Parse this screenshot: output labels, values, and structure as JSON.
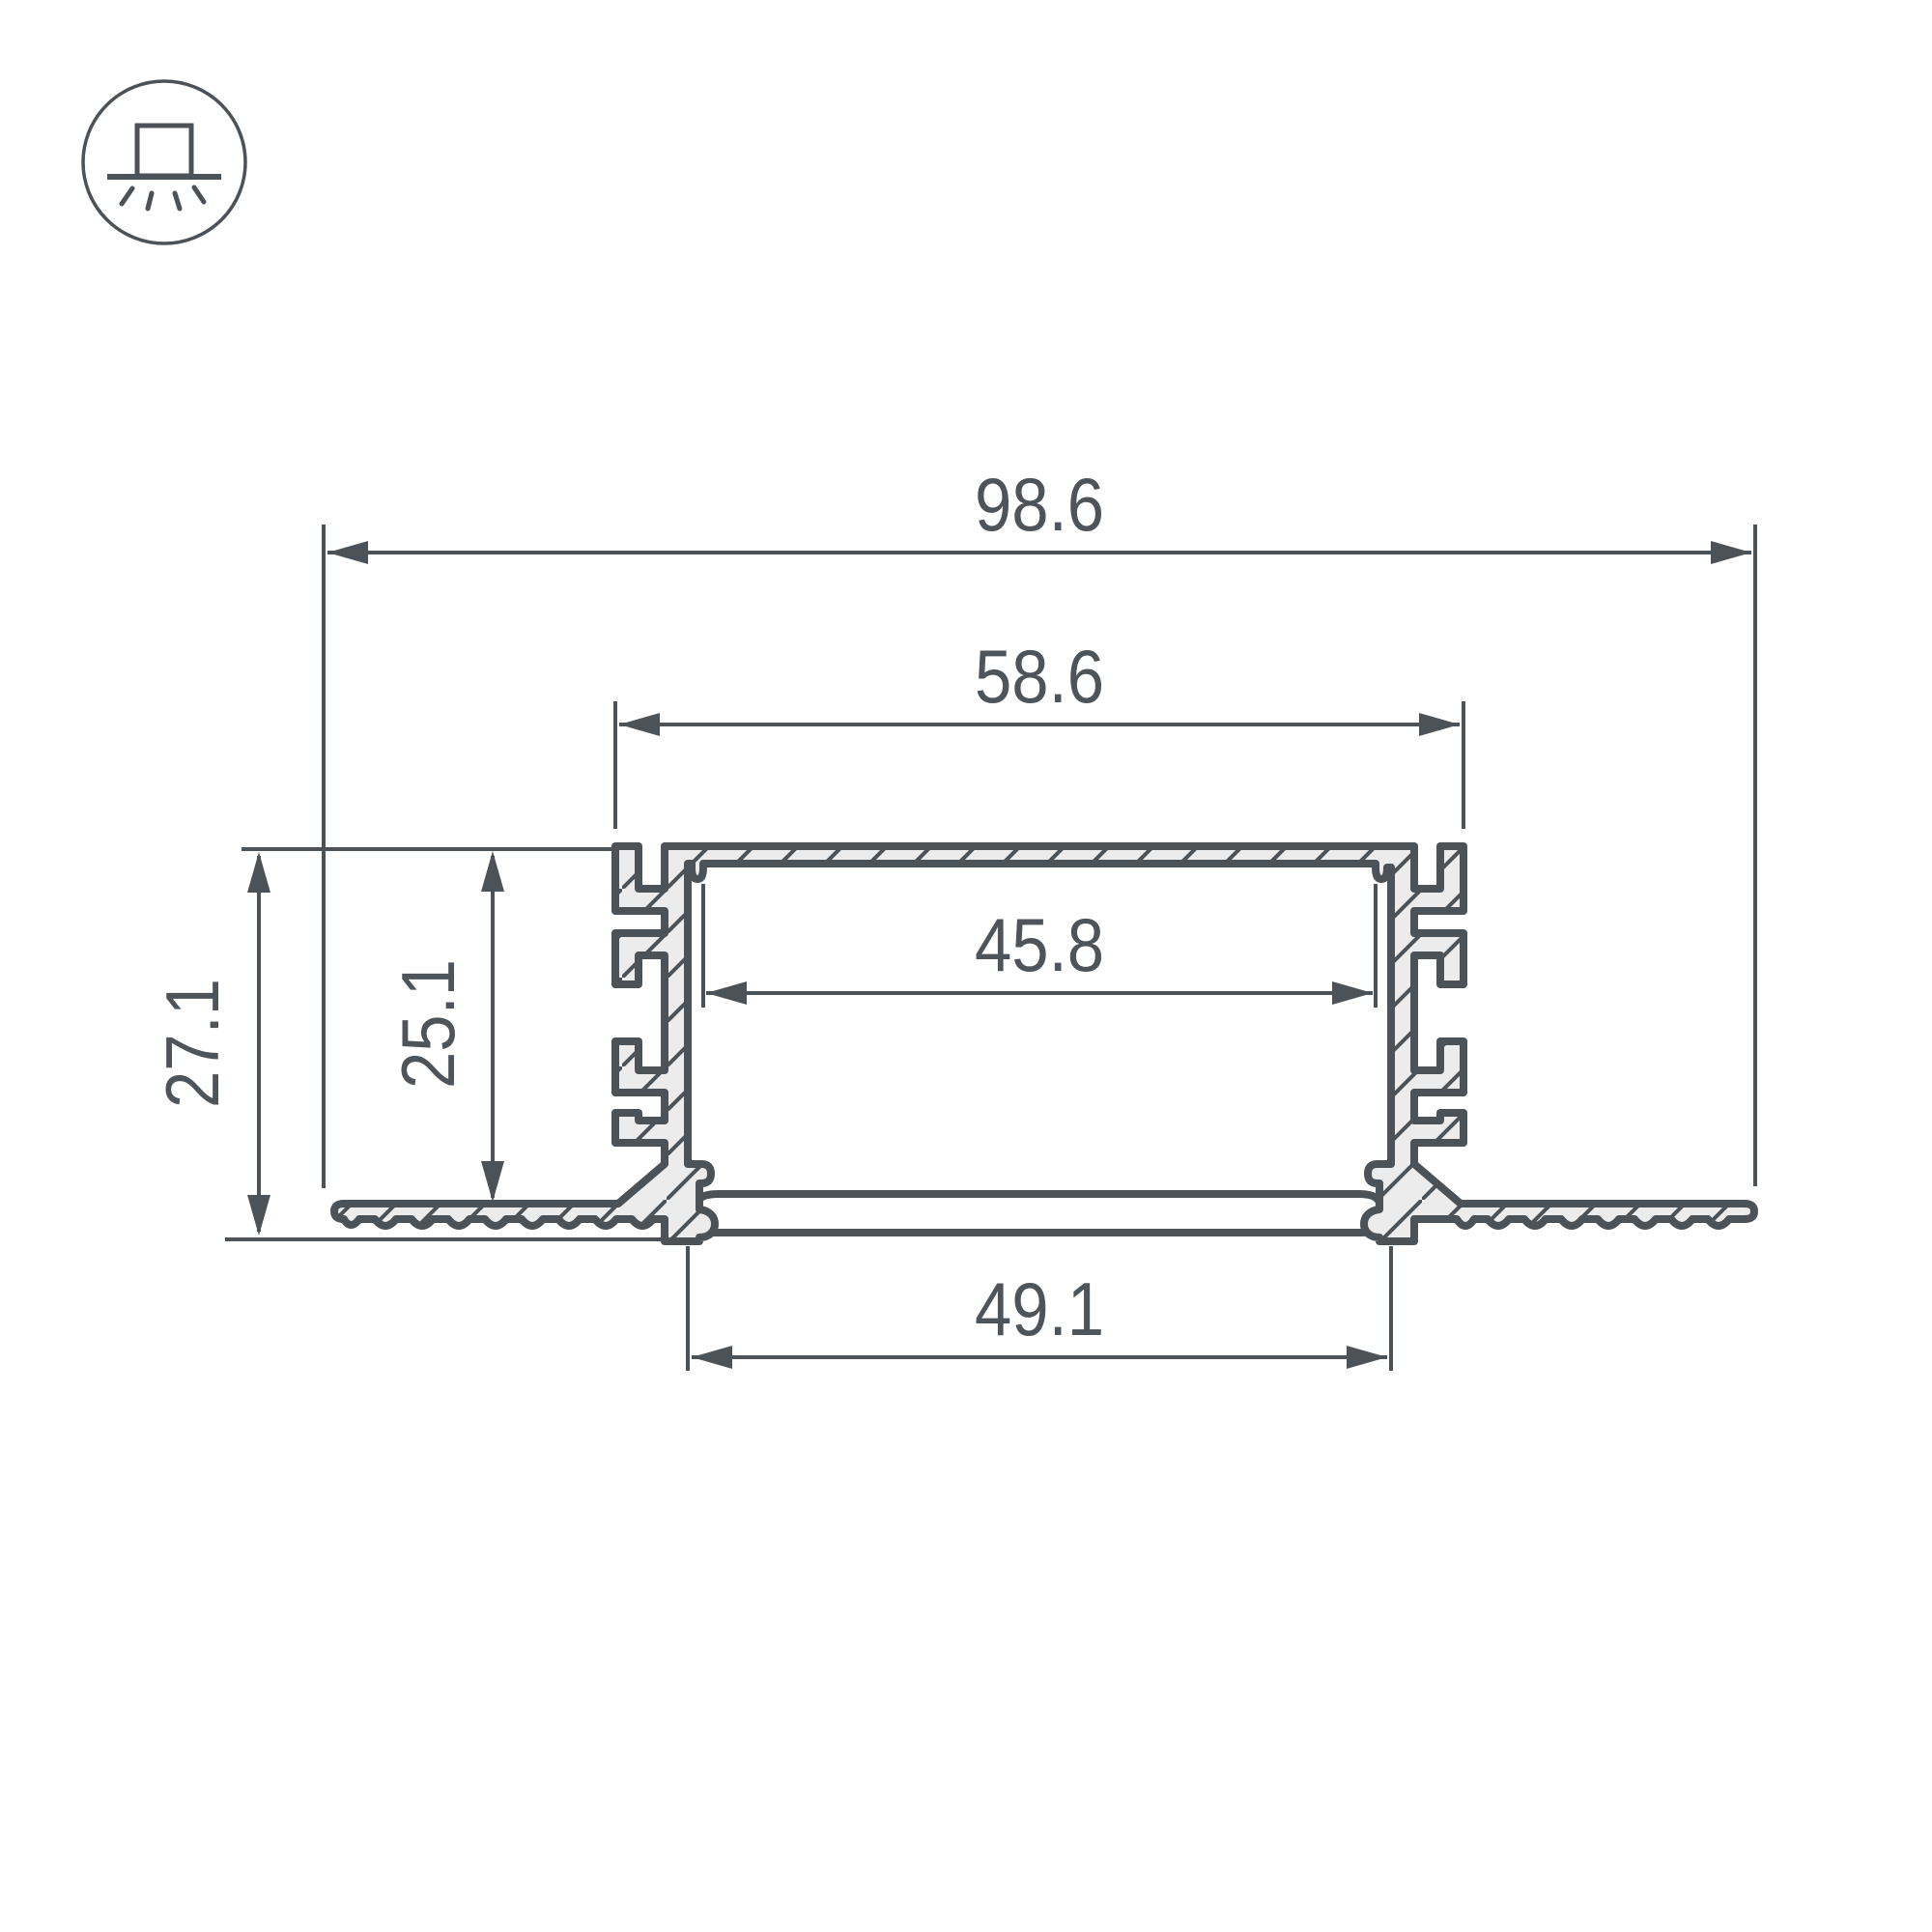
{
  "drawing": {
    "title": "recessed-led-profile-cross-section",
    "dimensions": {
      "overall_width": "98.6",
      "channel_outer_width": "58.6",
      "inner_width": "45.8",
      "diffuser_width": "49.1",
      "overall_height": "27.1",
      "channel_depth": "25.1"
    },
    "colors": {
      "line": "#4b5258",
      "fill": "#ececec",
      "text": "#4d545a",
      "diffuser_fill": "#ffffff",
      "background": "#ffffff"
    },
    "icon": {
      "name": "recessed-mount-light-icon"
    }
  }
}
